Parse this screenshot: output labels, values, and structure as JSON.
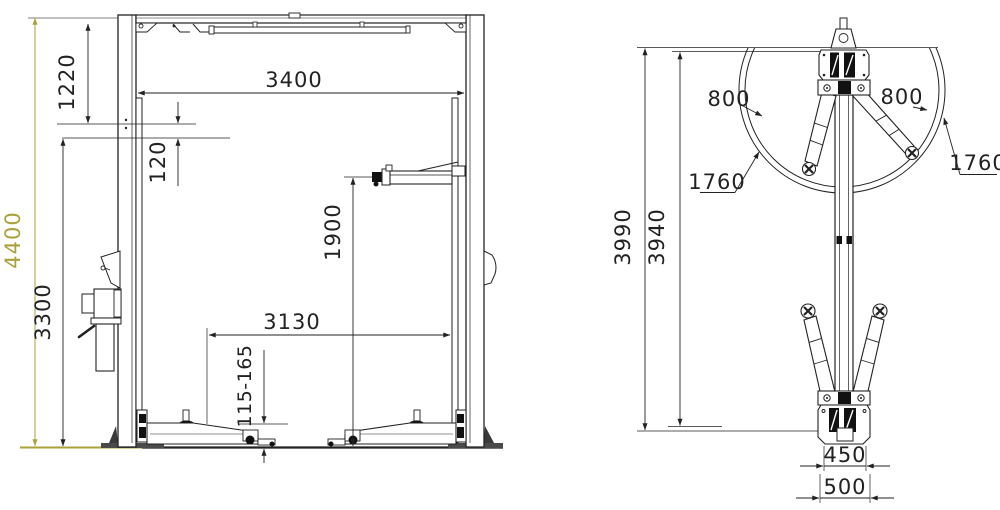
{
  "drawing": {
    "front_view": {
      "labels": {
        "overall_height": "4400",
        "column_clear_height": "3300",
        "top_beam_drop": "1220",
        "switch_bar_gap": "120",
        "inside_width": "3400",
        "lifting_height": "1900",
        "drive_through_width": "3130",
        "pad_height_range": "115-165"
      }
    },
    "side_view": {
      "labels": {
        "overall_height": "3990",
        "column_height": "3940",
        "arm_reach_min_left": "800",
        "arm_reach_min_right": "800",
        "arm_reach_max_left": "1760",
        "arm_reach_max_right": "1760",
        "base_width_inner": "450",
        "base_width_outer": "500"
      }
    },
    "colors": {
      "line": "#222222",
      "accent_olive": "#a9a23a",
      "background": "#ffffff"
    }
  }
}
